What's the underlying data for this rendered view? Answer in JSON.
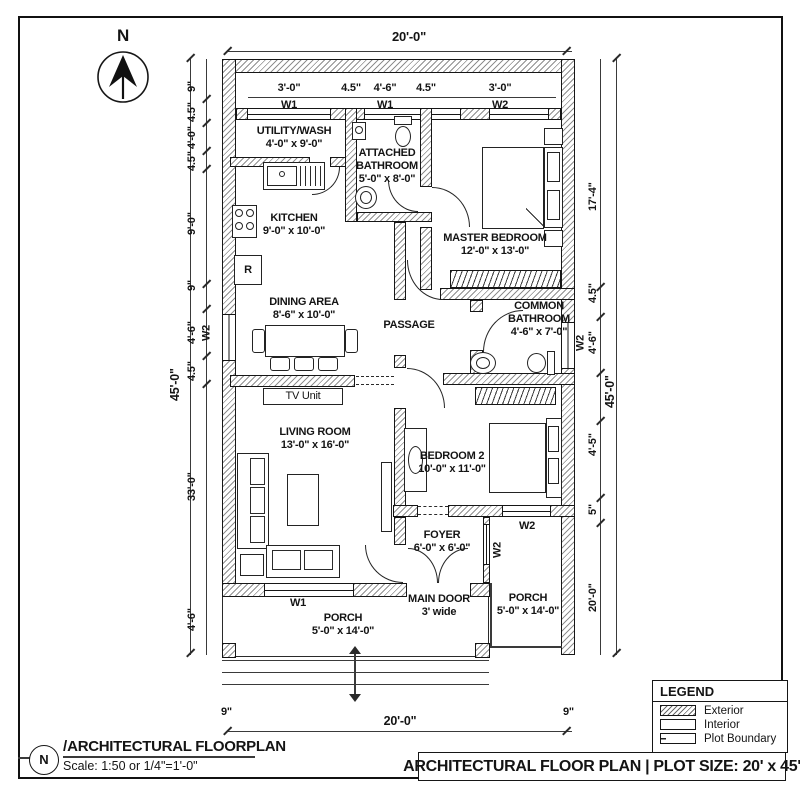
{
  "colors": {
    "ink": "#161616",
    "hatch_gray": "#8f8f8f",
    "background": "#ffffff"
  },
  "compass": {
    "label": "N"
  },
  "dims": {
    "top": "20'-0\"",
    "bottom": "20'-0\"",
    "bottom_offset_left": "9\"",
    "bottom_offset_right": "9\"",
    "overall_left": "45'-0\"",
    "overall_right": "45'-0\"",
    "left_chain": [
      "9\"",
      "4.5\"",
      "4'-0\"",
      "4.5\"",
      "9'-0\"",
      "9\"",
      "4'-6\"",
      "4.5\"",
      "33'-0\"",
      "4'-6\""
    ],
    "left_window_tag": "W2",
    "right_chain": [
      "17'-4\"",
      "4.5\"",
      "4'-6\"",
      "4'-5\"",
      "5\"",
      "20'-0\""
    ],
    "right_window_tag": "W2",
    "window_row": {
      "d1": "3'-0\"",
      "d2": "4.5\"",
      "d3": "4'-6\"",
      "d4": "4.5\"",
      "d5": "3'-0\"",
      "w1a": "W1",
      "w1b": "W1",
      "w2": "W2"
    }
  },
  "rooms": {
    "utility": {
      "name": "UTILITY/WASH",
      "size": "4'-0\" x 9'-0\""
    },
    "attached_bath": {
      "name1": "ATTACHED",
      "name2": "BATHROOM",
      "size": "5'-0\" x 8'-0\""
    },
    "master": {
      "name": "MASTER BEDROOM",
      "size": "12'-0\" x 13'-0\""
    },
    "kitchen": {
      "name": "KITCHEN",
      "size": "9'-0\" x 10'-0\""
    },
    "dining": {
      "name": "DINING AREA",
      "size": "8'-6\" x 10'-0\""
    },
    "passage": {
      "name": "PASSAGE"
    },
    "common_bath": {
      "name1": "COMMON",
      "name2": "BATHROOM",
      "size": "4'-6\" x 7'-0\""
    },
    "living": {
      "name": "LIVING ROOM",
      "size": "13'-0\" x 16'-0\""
    },
    "bedroom2": {
      "name": "BEDROOM 2",
      "size": "10'-0\" x 11'-0\""
    },
    "foyer": {
      "name": "FOYER",
      "size": "6'-0\" x 6'-0\""
    },
    "main_door": {
      "name": "MAIN DOOR",
      "size": "3' wide"
    },
    "porch_front": {
      "name": "PORCH",
      "size": "5'-0\" x 14'-0\""
    },
    "porch_side": {
      "name": "PORCH",
      "size": "5'-0\" x 14'-0\""
    },
    "tv_unit": {
      "label": "TV Unit"
    },
    "tags": {
      "w1_bottom": "W1",
      "w2_foyer": "W2",
      "w2_bedroom": "W2",
      "fridge": "R"
    }
  },
  "legend": {
    "title": "LEGEND",
    "items": [
      {
        "label": "Exterior",
        "swatch": "hatch"
      },
      {
        "label": "Interior",
        "swatch": "plain"
      },
      {
        "label": "Plot Boundary",
        "swatch": "dashed"
      }
    ]
  },
  "footer": {
    "marker": "N",
    "slash": "/",
    "plan_title": "ARCHITECTURAL FLOORPLAN",
    "scale": "Scale: 1:50 or 1/4\"=1'-0\"",
    "title_block": "ARCHITECTURAL FLOOR PLAN | PLOT SIZE: 20' x 45'"
  }
}
